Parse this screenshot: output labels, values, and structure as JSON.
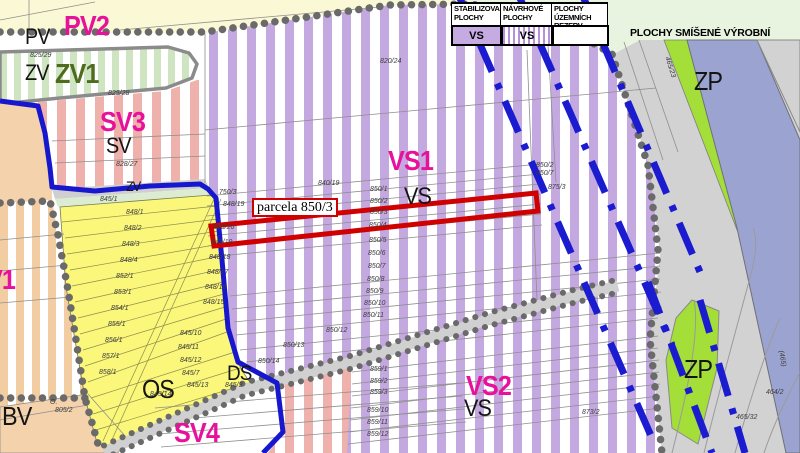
{
  "legend": {
    "columns": [
      {
        "title_line1": "STABILIZOVANÉ",
        "title_line2": "PLOCHY",
        "code": "VS",
        "swatch": "solid"
      },
      {
        "title_line1": "NÁVRHOVÉ",
        "title_line2": "PLOCHY",
        "code": "VS",
        "swatch": "striped"
      },
      {
        "title_line1": "PLOCHY ÚZEMNÍCH",
        "title_line2": "REZERV",
        "code": "",
        "swatch": "empty"
      }
    ],
    "right_label": "PLOCHY SMÍŠENÉ VÝROBNÍ"
  },
  "highlight": {
    "label": "parcela 850/3"
  },
  "colors": {
    "magenta": "#e8119b",
    "black": "#151515",
    "darkgreen": "#4f6b1d",
    "parcel": "#3c3c3c",
    "boundary_blue": "#1717cd",
    "reserve_dash_blue": "#1b1bcf",
    "highlight_red": "#cf0000",
    "vs_purple_stripe": "#c4a9e1",
    "sv_pink_stripe": "#efb1ab",
    "os_yellow": "#fbf77a",
    "zp_green": "#a3de39",
    "zv_green_stripe": "#cfe5c1",
    "bv_peach": "#f4d2ab",
    "road_gray": "#d2d2d2",
    "blue_gray_band": "#9ba4d1"
  },
  "zone_labels": [
    {
      "t": "PV2",
      "x": 64,
      "y": 12,
      "s": 28,
      "c": "magenta",
      "b": 1
    },
    {
      "t": "PV",
      "x": 25,
      "y": 26,
      "s": 22,
      "c": "black",
      "b": 0
    },
    {
      "t": "ZV1",
      "x": 55,
      "y": 60,
      "s": 28,
      "c": "darkgreen",
      "b": 1
    },
    {
      "t": "ZV",
      "x": 25,
      "y": 62,
      "s": 22,
      "c": "black",
      "b": 0
    },
    {
      "t": "SV3",
      "x": 100,
      "y": 108,
      "s": 28,
      "c": "magenta",
      "b": 1
    },
    {
      "t": "SV",
      "x": 106,
      "y": 135,
      "s": 22,
      "c": "black",
      "b": 0
    },
    {
      "t": "VS1",
      "x": 388,
      "y": 147,
      "s": 28,
      "c": "magenta",
      "b": 1
    },
    {
      "t": "VS",
      "x": 404,
      "y": 185,
      "s": 24,
      "c": "black",
      "b": 0
    },
    {
      "t": "V1",
      "x": -14,
      "y": 266,
      "s": 28,
      "c": "magenta",
      "b": 1
    },
    {
      "t": "OS",
      "x": 142,
      "y": 376,
      "s": 26,
      "c": "black",
      "b": 0
    },
    {
      "t": "DS",
      "x": 227,
      "y": 363,
      "s": 21,
      "c": "black",
      "b": 0
    },
    {
      "t": "BV",
      "x": 2,
      "y": 403,
      "s": 26,
      "c": "black",
      "b": 0
    },
    {
      "t": "SV4",
      "x": 174,
      "y": 419,
      "s": 28,
      "c": "magenta",
      "b": 1
    },
    {
      "t": "VS2",
      "x": 466,
      "y": 372,
      "s": 28,
      "c": "magenta",
      "b": 1
    },
    {
      "t": "VS",
      "x": 464,
      "y": 397,
      "s": 24,
      "c": "black",
      "b": 0
    },
    {
      "t": "ZP",
      "x": 694,
      "y": 68,
      "s": 26,
      "c": "black",
      "b": 0
    },
    {
      "t": "ZP",
      "x": 684,
      "y": 356,
      "s": 26,
      "c": "black",
      "b": 0
    },
    {
      "t": "ZV",
      "x": 126,
      "y": 179,
      "s": 14,
      "c": "black",
      "b": 0
    }
  ],
  "parcel_labels": [
    {
      "t": "825/29",
      "x": 30,
      "y": 52
    },
    {
      "t": "825/28",
      "x": 108,
      "y": 90
    },
    {
      "t": "828/27",
      "x": 116,
      "y": 161
    },
    {
      "t": "820/24",
      "x": 380,
      "y": 58
    },
    {
      "t": "845/1",
      "x": 100,
      "y": 196
    },
    {
      "t": "750/3",
      "x": 219,
      "y": 189
    },
    {
      "t": "848/19",
      "x": 223,
      "y": 201
    },
    {
      "t": "840/19",
      "x": 318,
      "y": 180
    },
    {
      "t": "850/1",
      "x": 370,
      "y": 186
    },
    {
      "t": "850/2",
      "x": 370,
      "y": 198
    },
    {
      "t": "850/3",
      "x": 370,
      "y": 209
    },
    {
      "t": "850/4",
      "x": 369,
      "y": 222
    },
    {
      "t": "850/5",
      "x": 369,
      "y": 237
    },
    {
      "t": "850/6",
      "x": 368,
      "y": 250
    },
    {
      "t": "850/7",
      "x": 368,
      "y": 263
    },
    {
      "t": "850/8",
      "x": 367,
      "y": 276
    },
    {
      "t": "850/9",
      "x": 366,
      "y": 288
    },
    {
      "t": "850/10",
      "x": 364,
      "y": 300
    },
    {
      "t": "850/11",
      "x": 363,
      "y": 312
    },
    {
      "t": "850/12",
      "x": 326,
      "y": 327
    },
    {
      "t": "850/13",
      "x": 283,
      "y": 342
    },
    {
      "t": "850/14",
      "x": 258,
      "y": 358
    },
    {
      "t": "850/2",
      "x": 536,
      "y": 162
    },
    {
      "t": "850/7",
      "x": 536,
      "y": 170
    },
    {
      "t": "875/3",
      "x": 548,
      "y": 184
    },
    {
      "t": "859/1",
      "x": 370,
      "y": 366
    },
    {
      "t": "859/2",
      "x": 370,
      "y": 378
    },
    {
      "t": "859/3",
      "x": 370,
      "y": 389
    },
    {
      "t": "859/10",
      "x": 367,
      "y": 407
    },
    {
      "t": "859/11",
      "x": 367,
      "y": 419
    },
    {
      "t": "859/12",
      "x": 367,
      "y": 431
    },
    {
      "t": "873/2",
      "x": 582,
      "y": 409
    },
    {
      "t": "848/1",
      "x": 126,
      "y": 209
    },
    {
      "t": "848/2",
      "x": 124,
      "y": 225
    },
    {
      "t": "848/3",
      "x": 122,
      "y": 241
    },
    {
      "t": "848/4",
      "x": 120,
      "y": 257
    },
    {
      "t": "852/1",
      "x": 116,
      "y": 273
    },
    {
      "t": "853/1",
      "x": 114,
      "y": 289
    },
    {
      "t": "854/1",
      "x": 111,
      "y": 305
    },
    {
      "t": "855/1",
      "x": 108,
      "y": 321
    },
    {
      "t": "856/1",
      "x": 105,
      "y": 337
    },
    {
      "t": "857/1",
      "x": 102,
      "y": 353
    },
    {
      "t": "858/1",
      "x": 99,
      "y": 369
    },
    {
      "t": "848/20",
      "x": 213,
      "y": 224
    },
    {
      "t": "848/19",
      "x": 211,
      "y": 239
    },
    {
      "t": "848/18",
      "x": 209,
      "y": 254
    },
    {
      "t": "848/17",
      "x": 207,
      "y": 269
    },
    {
      "t": "848/16",
      "x": 205,
      "y": 284
    },
    {
      "t": "848/15",
      "x": 203,
      "y": 299
    },
    {
      "t": "845/10",
      "x": 180,
      "y": 330
    },
    {
      "t": "845/11",
      "x": 178,
      "y": 344
    },
    {
      "t": "845/12",
      "x": 180,
      "y": 357
    },
    {
      "t": "845/7",
      "x": 182,
      "y": 370
    },
    {
      "t": "845/13",
      "x": 187,
      "y": 382
    },
    {
      "t": "845/14",
      "x": 150,
      "y": 391
    },
    {
      "t": "845/3",
      "x": 225,
      "y": 382
    },
    {
      "t": "O.",
      "x": 50,
      "y": 399
    },
    {
      "t": "805/2",
      "x": 55,
      "y": 407
    },
    {
      "t": "465/23",
      "x": 670,
      "y": 56,
      "r": 72
    },
    {
      "t": "(465)",
      "x": 784,
      "y": 350,
      "r": 80
    },
    {
      "t": "465/32",
      "x": 736,
      "y": 414
    },
    {
      "t": "464/2",
      "x": 766,
      "y": 389
    }
  ]
}
